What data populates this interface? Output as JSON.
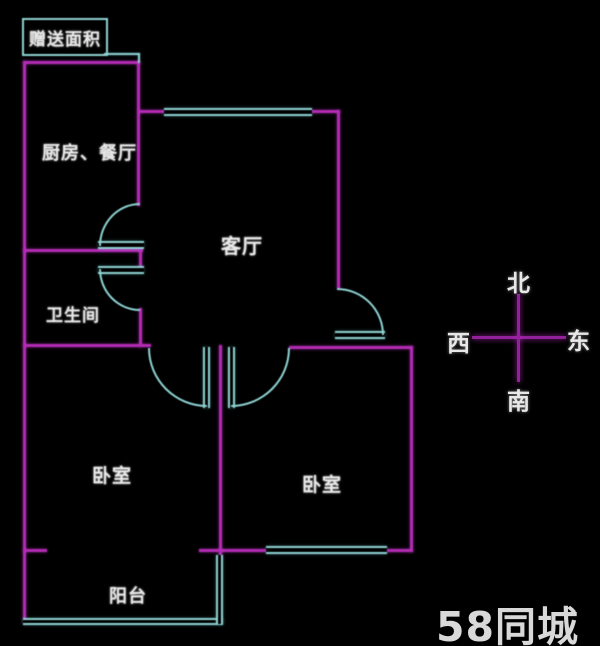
{
  "plan": {
    "bonus_area_label": "赠送面积",
    "rooms": {
      "kitchen_dining": "厨房、餐厅",
      "living_room": "客厅",
      "bathroom": "卫生间",
      "bedroom_left": "卧室",
      "bedroom_right": "卧室",
      "balcony": "阳台"
    }
  },
  "compass": {
    "north": "北",
    "west": "西",
    "east": "东",
    "south": "南"
  },
  "watermark": {
    "logo": "58同城"
  },
  "colors": {
    "background": "#000000",
    "wall": "#b32ab3",
    "window_door": "#8ed2d2",
    "label_text": "#e8e8e8",
    "compass_line": "#93209b",
    "watermark_text": "#d8d8d8"
  }
}
